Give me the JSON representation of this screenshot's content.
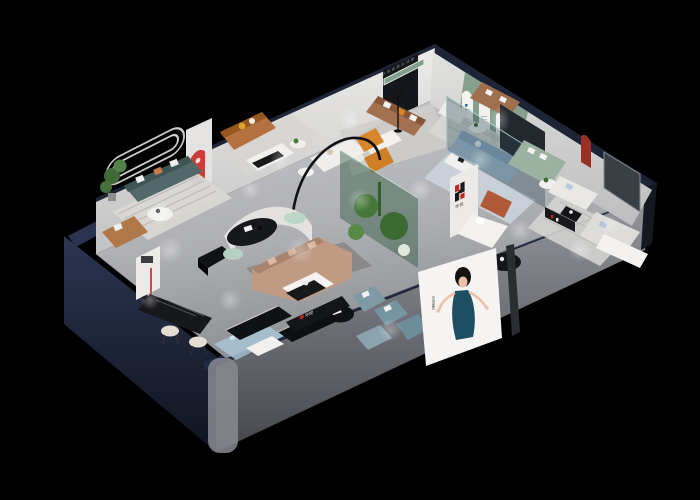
{
  "brand": {
    "logo_mark": "H",
    "name": "华悦",
    "shelf_label": "华悦",
    "poster_side_text": "华悦家居",
    "wall_text": "华悦家居生活馆"
  },
  "colors": {
    "background": "#000000",
    "exterior_navy": "#27304a",
    "exterior_navy_dark": "#141a2a",
    "exterior_gray": "#7b7e86",
    "interior_wall": "#e6e5e3",
    "floor": "#b3b4b8",
    "accent_red": "#c2251c",
    "logo_black": "#191919",
    "green_wall": "#87a08e",
    "teal_sofa": "#51696a",
    "brown_sofa": "#a3714f",
    "caramel_sofa": "#b5713f",
    "tan_sectional": "#c09a82",
    "orange_accent": "#d8862c",
    "steel_blue": "#7f9aa6",
    "light_blue_sofa": "#a9c0d8",
    "sage_green": "#9cb2a0",
    "mint": "#bdd6ca",
    "poster_dress": "#1d4f63",
    "rug_blue": "#a9c4d4"
  }
}
